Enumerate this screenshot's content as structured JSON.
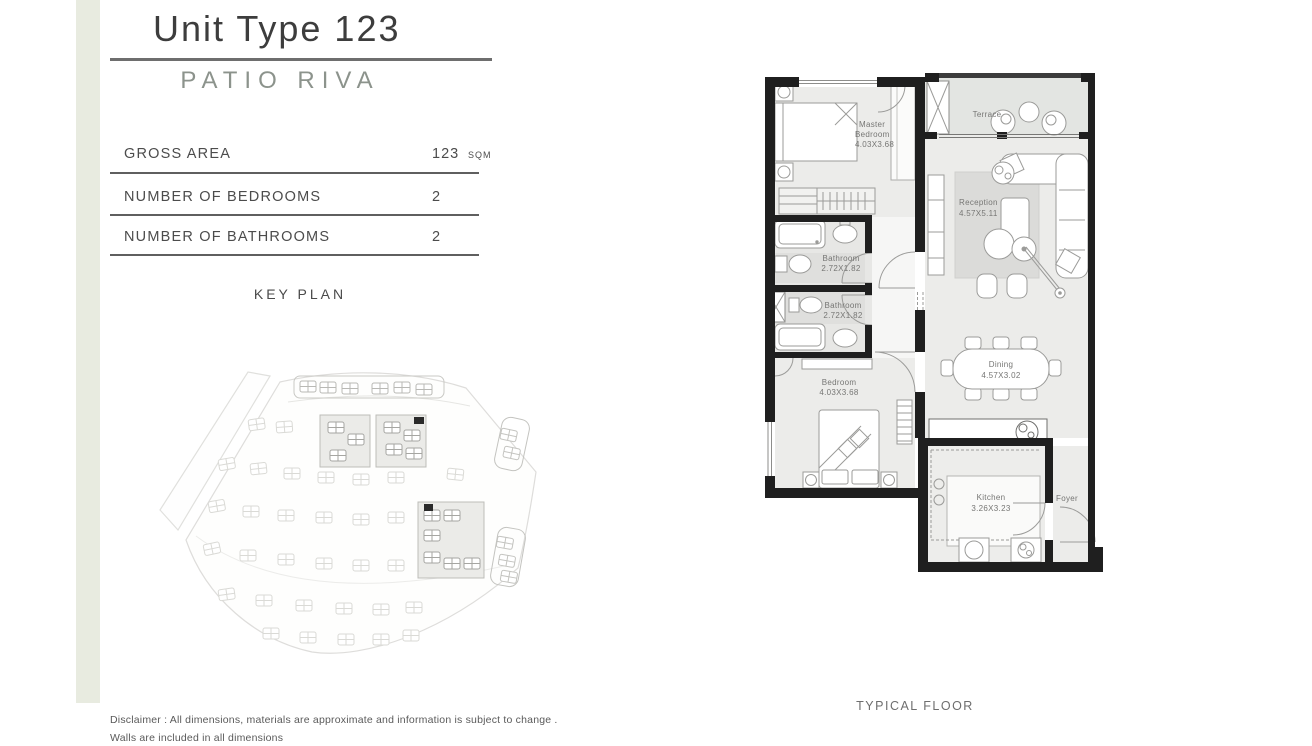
{
  "page": {
    "title": "Unit Type 123",
    "subtitle": "PATIO RIVA"
  },
  "specs": {
    "rows": [
      {
        "label": "GROSS AREA",
        "value": "123",
        "unit": "SQM"
      },
      {
        "label": "NUMBER OF BEDROOMS",
        "value": "2",
        "unit": ""
      },
      {
        "label": "NUMBER OF BATHROOMS",
        "value": "2",
        "unit": ""
      }
    ]
  },
  "key_plan": {
    "heading": "KEY PLAN"
  },
  "floor_plan": {
    "floor_label": "TYPICAL FLOOR",
    "rooms": [
      {
        "id": "master-bedroom",
        "lines": [
          "Master",
          "Bedroom",
          "4.03X3.68"
        ]
      },
      {
        "id": "terrace",
        "lines": [
          "Terrace"
        ]
      },
      {
        "id": "reception",
        "lines": [
          "Reception",
          "4.57X5.11"
        ]
      },
      {
        "id": "bathroom-1",
        "lines": [
          "Bathroom",
          "2.72X1.82"
        ]
      },
      {
        "id": "bathroom-2",
        "lines": [
          "Bathroom",
          "2.72X1.82"
        ]
      },
      {
        "id": "bedroom",
        "lines": [
          "Bedroom",
          "4.03X3.68"
        ]
      },
      {
        "id": "dining",
        "lines": [
          "Dining",
          "4.57X3.02"
        ]
      },
      {
        "id": "kitchen",
        "lines": [
          "Kitchen",
          "3.26X3.23"
        ]
      },
      {
        "id": "foyer",
        "lines": [
          "Foyer"
        ]
      }
    ]
  },
  "disclaimer": {
    "line1": "Disclaimer : All dimensions, materials are approximate and information is subject to change .",
    "line2": "Walls are included in all dimensions"
  },
  "colors": {
    "accent_strip": "#e8ebe0",
    "wall": "#1f1f1f",
    "room_fill": "#ececea",
    "terrace_fill": "#e3e5e2",
    "rug_fill": "#dbdbd9",
    "subtitle_text": "#8c938c"
  }
}
